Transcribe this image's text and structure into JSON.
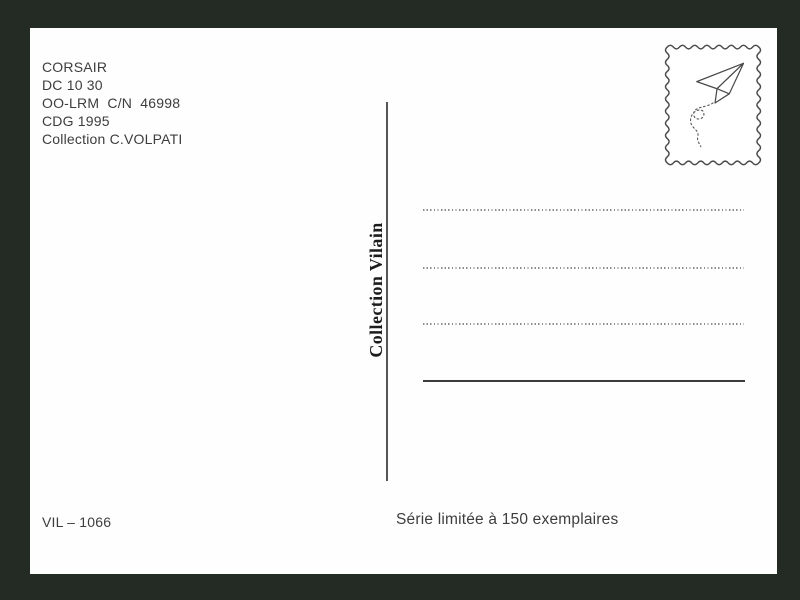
{
  "postcard": {
    "info": {
      "lines": [
        "CORSAIR",
        "DC 10 30",
        "OO-LRM  C/N  46998",
        "CDG 1995",
        "Collection C.VOLPATI"
      ]
    },
    "publisher_label": "Collection Vilain",
    "stamp_icon": "paper-plane-icon",
    "address_area": {
      "dotted_lines": 3,
      "signature_lines": 1
    },
    "footer": {
      "reference": "VIL – 1066",
      "edition": "Série limitée à 150 exemplaires"
    },
    "colors": {
      "frame_background": "#242a24",
      "card_background": "#fefefe",
      "text": "#3d3d3d",
      "publisher_text": "#1c1c1c",
      "divider_line": "#565656",
      "dotted_line": "#8d8d8d",
      "signature_line": "#3c3c3c",
      "stamp_outline": "#4a4a4a"
    }
  }
}
